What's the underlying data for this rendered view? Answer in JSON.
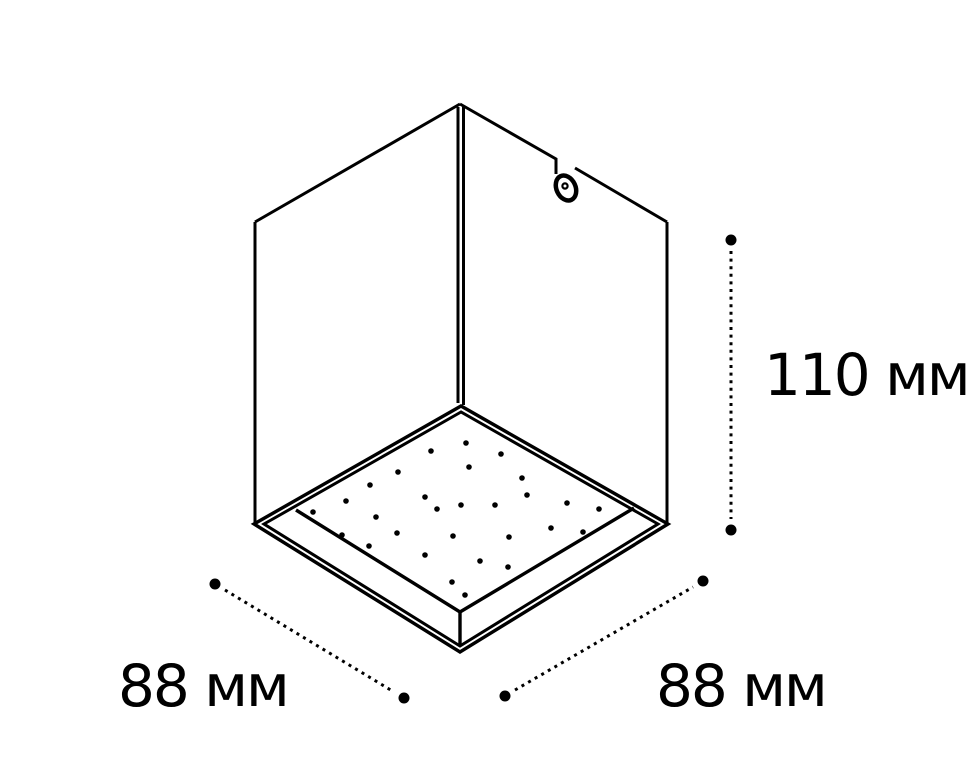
{
  "diagram": {
    "background_color": "#ffffff",
    "line_color": "#000000"
  },
  "dimensions": {
    "height": {
      "value": 110,
      "unit": "мм",
      "label": "110 мм"
    },
    "width_left": {
      "value": 88,
      "unit": "мм",
      "label": "88 мм"
    },
    "width_right": {
      "value": 88,
      "unit": "мм",
      "label": "88 мм"
    }
  },
  "led_panel": {
    "dot_radius": 2.8,
    "dots": [
      [
        431,
        451
      ],
      [
        466,
        443
      ],
      [
        501,
        454
      ],
      [
        398,
        472
      ],
      [
        469,
        467
      ],
      [
        522,
        478
      ],
      [
        370,
        485
      ],
      [
        346,
        501
      ],
      [
        425,
        497
      ],
      [
        527,
        495
      ],
      [
        461,
        505
      ],
      [
        495,
        505
      ],
      [
        437,
        509
      ],
      [
        313,
        512
      ],
      [
        567,
        503
      ],
      [
        599,
        509
      ],
      [
        376,
        517
      ],
      [
        342,
        535
      ],
      [
        397,
        533
      ],
      [
        453,
        536
      ],
      [
        551,
        528
      ],
      [
        583,
        532
      ],
      [
        369,
        546
      ],
      [
        509,
        537
      ],
      [
        425,
        555
      ],
      [
        480,
        561
      ],
      [
        508,
        567
      ],
      [
        452,
        582
      ],
      [
        465,
        595
      ]
    ]
  }
}
